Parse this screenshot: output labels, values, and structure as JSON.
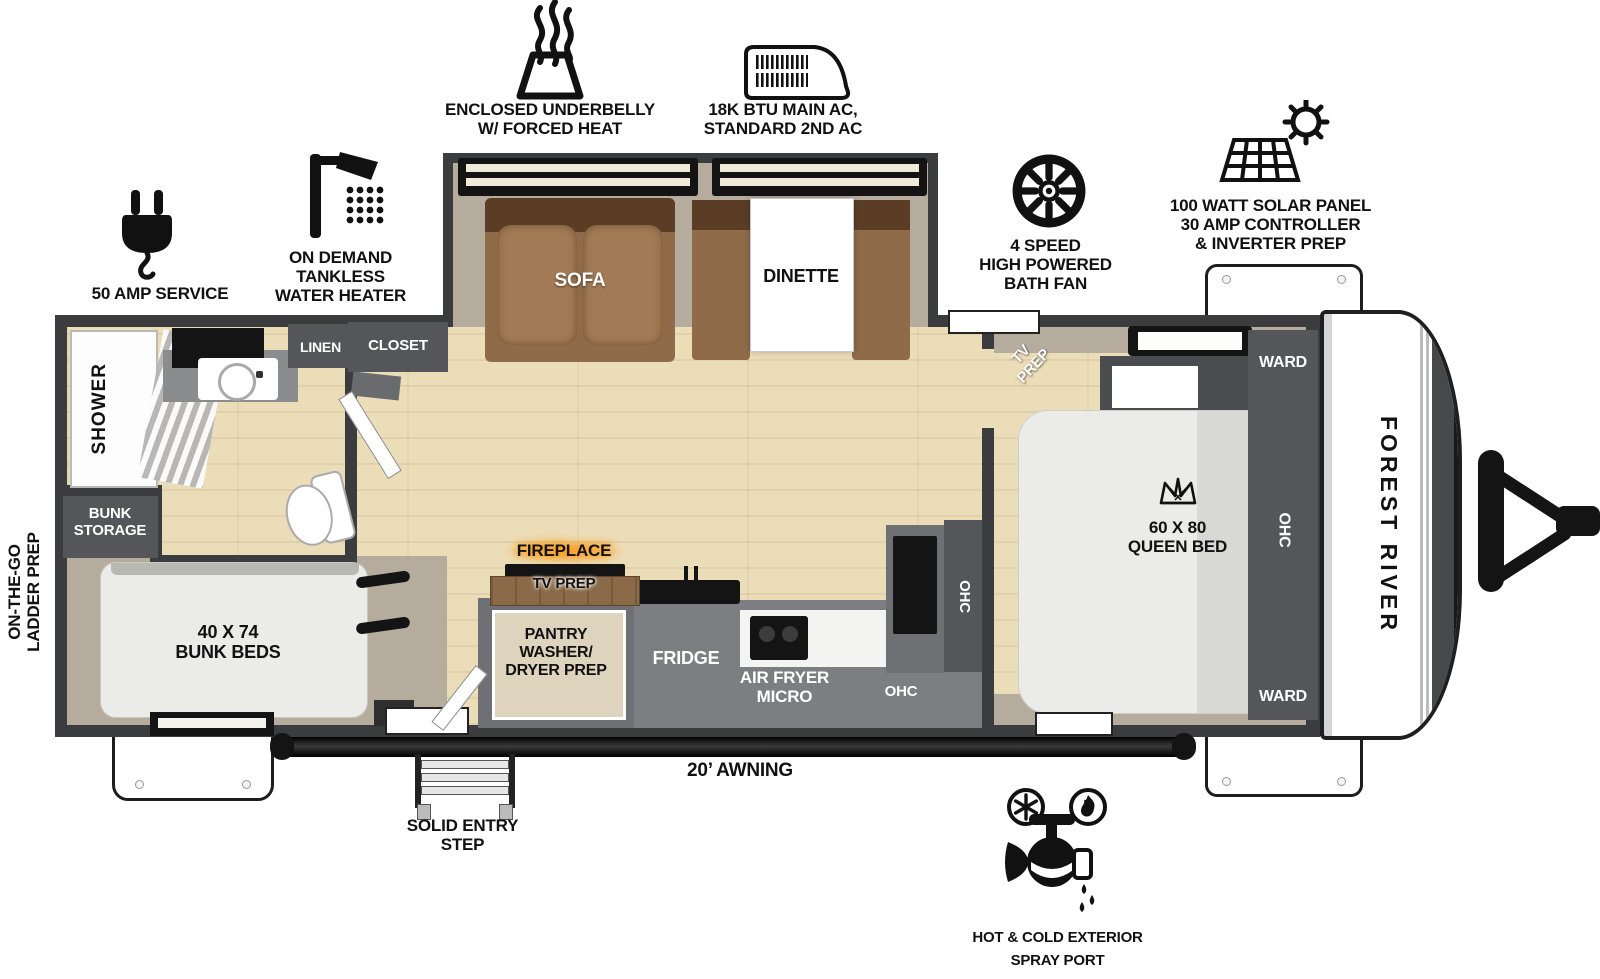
{
  "title": "Forest River Travel Trailer Floorplan",
  "brand": "FOREST RIVER",
  "features": {
    "underbelly": "ENCLOSED UNDERBELLY\nW/ FORCED HEAT",
    "ac": "18K BTU MAIN AC,\nSTANDARD 2ND AC",
    "fan": "4 SPEED\nHIGH POWERED\nBATH FAN",
    "solar": "100 WATT SOLAR PANEL\n30 AMP CONTROLLER\n& INVERTER PREP",
    "water_heater": "ON DEMAND\nTANKLESS\nWATER HEATER",
    "amp50": "50 AMP SERVICE",
    "ladder": "ON-THE-GO\nLADDER PREP",
    "spray": "HOT & COLD EXTERIOR\nSPRAY PORT",
    "awning": "20’ AWNING",
    "step": "SOLID ENTRY\nSTEP"
  },
  "rooms": {
    "shower": "SHOWER",
    "linen": "LINEN",
    "closet": "CLOSET",
    "bunk_storage": "BUNK\nSTORAGE",
    "bunk_beds": "40 X 74\nBUNK BEDS",
    "sofa": "SOFA",
    "dinette": "DINETTE",
    "fireplace": "FIREPLACE",
    "tv_prep": "TV PREP",
    "pantry": "PANTRY\nWASHER/\nDRYER PREP",
    "fridge": "FRIDGE",
    "airfryer": "AIR FRYER\nMICRO",
    "ohc": "OHC",
    "bed_tv_prep": "TV\nPREP",
    "queen": "60 X 80\nQUEEN BED",
    "ward": "WARD"
  },
  "colors": {
    "wall": "#3b3c3e",
    "body_tan": "#b5ac9e",
    "wood_floor": "#ecddb9",
    "cabinet": "#55565a",
    "sofa_brown": "#8f6b4a",
    "fireplace_glow": "#ff8c00"
  }
}
